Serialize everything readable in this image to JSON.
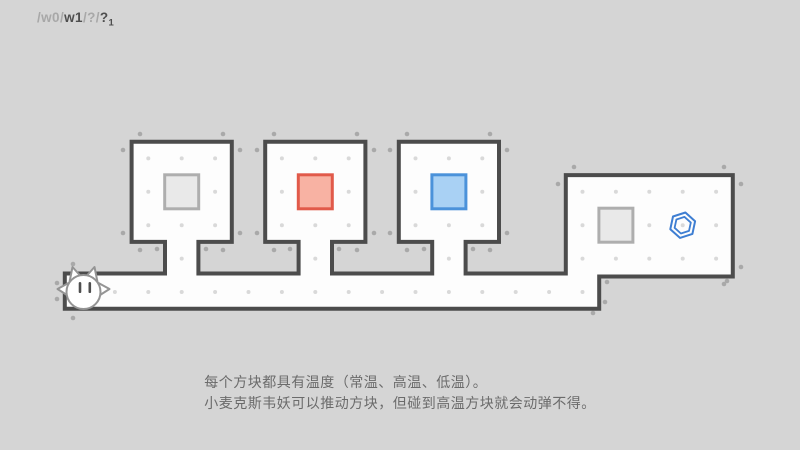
{
  "breadcrumb": {
    "segments": [
      {
        "text": "/w0/",
        "muted": true
      },
      {
        "text": "w1",
        "muted": false
      },
      {
        "text": "/?/",
        "muted": true
      },
      {
        "text": "?",
        "muted": false
      },
      {
        "text": "1",
        "muted": false,
        "subscript": true
      }
    ]
  },
  "tutorial": {
    "line1": "每个方块都具有温度（常温、高温、低温）。",
    "line2": "小麦克斯韦妖可以推动方块，但碰到高温方块就会动弹不得。"
  },
  "level": {
    "grid": {
      "cell": 33.4,
      "origin_x": 64.8,
      "origin_y": 141.7
    },
    "outline": [
      [
        64.8,
        273.5
      ],
      [
        165,
        273.5
      ],
      [
        165,
        241.9
      ],
      [
        131.6,
        241.9
      ],
      [
        131.6,
        141.7
      ],
      [
        231.8,
        141.7
      ],
      [
        231.8,
        241.9
      ],
      [
        198.4,
        241.9
      ],
      [
        198.4,
        273.5
      ],
      [
        298.6,
        273.5
      ],
      [
        298.6,
        241.9
      ],
      [
        265.2,
        241.9
      ],
      [
        265.2,
        141.7
      ],
      [
        365.4,
        141.7
      ],
      [
        365.4,
        241.9
      ],
      [
        332,
        241.9
      ],
      [
        332,
        273.5
      ],
      [
        432.2,
        273.5
      ],
      [
        432.2,
        241.9
      ],
      [
        398.8,
        241.9
      ],
      [
        398.8,
        141.7
      ],
      [
        499,
        141.7
      ],
      [
        499,
        241.9
      ],
      [
        465.6,
        241.9
      ],
      [
        465.6,
        273.5
      ],
      [
        565.8,
        273.5
      ],
      [
        565.8,
        175.1
      ],
      [
        732.8,
        175.1
      ],
      [
        732.8,
        276.5
      ],
      [
        599.2,
        276.5
      ],
      [
        599.2,
        308.7
      ],
      [
        64.8,
        308.7
      ]
    ],
    "dot_regions": [
      {
        "cols": [
          2,
          4
        ],
        "rows": [
          0,
          2
        ]
      },
      {
        "cols": [
          6,
          8
        ],
        "rows": [
          0,
          2
        ]
      },
      {
        "cols": [
          10,
          12
        ],
        "rows": [
          0,
          2
        ]
      },
      {
        "cols": [
          3,
          3
        ],
        "rows": [
          3,
          3
        ]
      },
      {
        "cols": [
          7,
          7
        ],
        "rows": [
          3,
          3
        ]
      },
      {
        "cols": [
          11,
          11
        ],
        "rows": [
          3,
          3
        ]
      },
      {
        "cols": [
          0,
          15
        ],
        "rows": [
          4,
          4
        ]
      },
      {
        "cols": [
          15,
          19
        ],
        "rows": [
          1,
          3
        ]
      }
    ],
    "outer_dots": [
      [
        57,
        283
      ],
      [
        73,
        264
      ],
      [
        57,
        299
      ],
      [
        73,
        318
      ],
      [
        123,
        233
      ],
      [
        140,
        250
      ],
      [
        123,
        150
      ],
      [
        140,
        134
      ],
      [
        240,
        150
      ],
      [
        223,
        134
      ],
      [
        240,
        233
      ],
      [
        223,
        250
      ],
      [
        257,
        233
      ],
      [
        274,
        250
      ],
      [
        257,
        150
      ],
      [
        274,
        134
      ],
      [
        374,
        150
      ],
      [
        357,
        134
      ],
      [
        374,
        233
      ],
      [
        357,
        250
      ],
      [
        390,
        233
      ],
      [
        407,
        250
      ],
      [
        390,
        150
      ],
      [
        407,
        134
      ],
      [
        507,
        150
      ],
      [
        490,
        134
      ],
      [
        507,
        233
      ],
      [
        490,
        250
      ],
      [
        558,
        184
      ],
      [
        574,
        167
      ],
      [
        741,
        184
      ],
      [
        724,
        167
      ],
      [
        741,
        267
      ],
      [
        724,
        284
      ],
      [
        607,
        282
      ],
      [
        727,
        281
      ],
      [
        605,
        302
      ],
      [
        593,
        313
      ],
      [
        157,
        249
      ],
      [
        206,
        249
      ],
      [
        290,
        249
      ],
      [
        339,
        249
      ],
      [
        424,
        249
      ],
      [
        473,
        249
      ]
    ],
    "blocks": [
      {
        "id": "block-normal-1",
        "col": 3,
        "row": 1,
        "temp": "normal"
      },
      {
        "id": "block-hot",
        "col": 7,
        "row": 1,
        "temp": "hot"
      },
      {
        "id": "block-cold",
        "col": 11,
        "row": 1,
        "temp": "cold"
      },
      {
        "id": "block-normal-2",
        "col": 16,
        "row": 2,
        "temp": "normal"
      }
    ],
    "goal": {
      "col": 18,
      "row": 2
    },
    "player": {
      "col": 0,
      "row": 4
    },
    "colors": {
      "background": "#d5d5d5",
      "wall": "#4c4c4c",
      "floor": "#fdfdfd",
      "dot_inner": "#d9d9d9",
      "dot_outer": "#a9a9a9",
      "goal": "#3e7ed2",
      "player_outline": "#949494",
      "eye": "#4f4f4f",
      "temps": {
        "normal": {
          "fill": "#e9e9e9",
          "stroke": "#aeaeae"
        },
        "hot": {
          "fill": "#f8b2a3",
          "stroke": "#e15a4a"
        },
        "cold": {
          "fill": "#a9d1f4",
          "stroke": "#4b92da"
        }
      }
    }
  }
}
